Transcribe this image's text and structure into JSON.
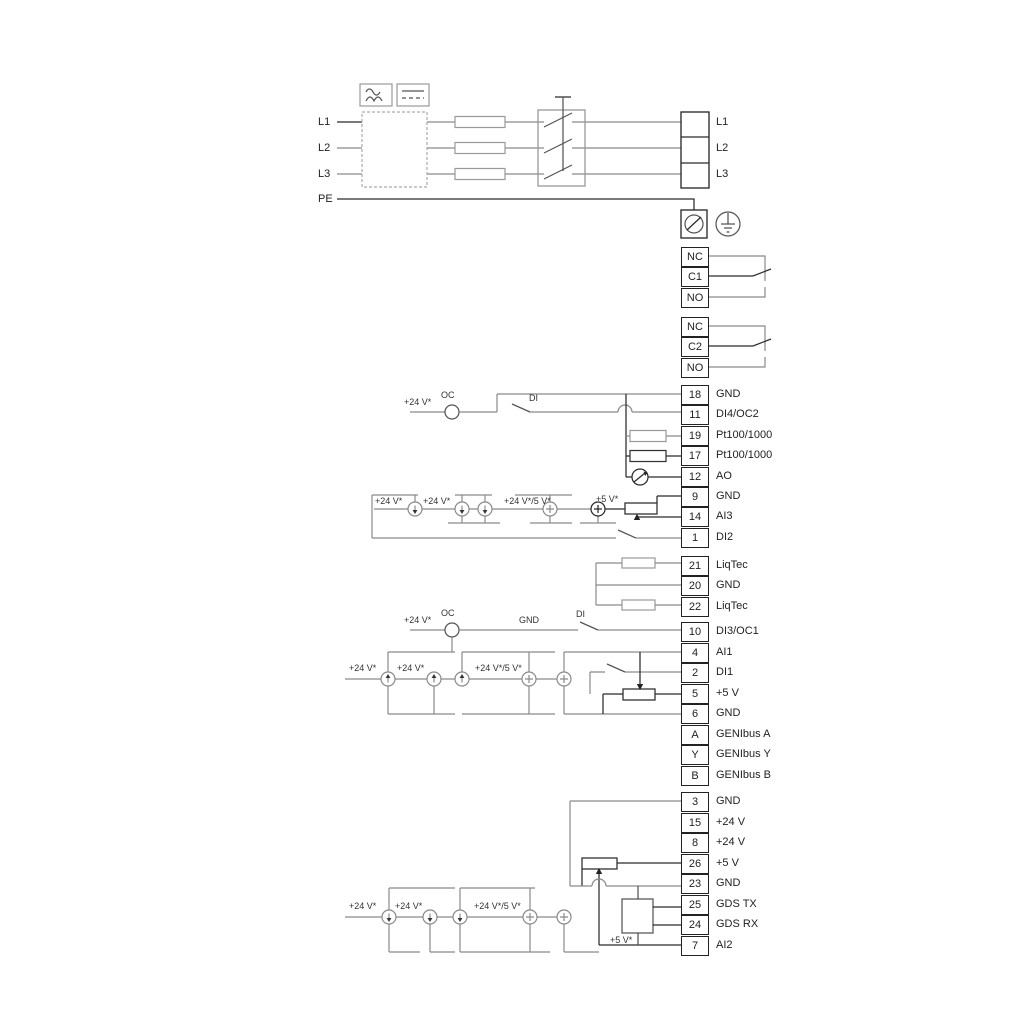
{
  "left_labels": {
    "l1": "L1",
    "l2": "L2",
    "l3": "L3",
    "pe": "PE"
  },
  "mains_out": {
    "l1": "L1",
    "l2": "L2",
    "l3": "L3"
  },
  "relays": [
    {
      "rows": [
        "NC",
        "C1",
        "NO"
      ]
    },
    {
      "rows": [
        "NC",
        "C2",
        "NO"
      ]
    }
  ],
  "stacks": {
    "io1": [
      {
        "id": "18",
        "label": "GND"
      },
      {
        "id": "11",
        "label": "DI4/OC2"
      },
      {
        "id": "19",
        "label": "Pt100/1000"
      },
      {
        "id": "17",
        "label": "Pt100/1000"
      },
      {
        "id": "12",
        "label": "AO"
      },
      {
        "id": "9",
        "label": "GND"
      },
      {
        "id": "14",
        "label": "AI3"
      },
      {
        "id": "1",
        "label": "DI2"
      }
    ],
    "liqtec": [
      {
        "id": "21",
        "label": "LiqTec"
      },
      {
        "id": "20",
        "label": "GND"
      },
      {
        "id": "22",
        "label": "LiqTec"
      }
    ],
    "io2": [
      {
        "id": "10",
        "label": "DI3/OC1"
      },
      {
        "id": "4",
        "label": "AI1"
      },
      {
        "id": "2",
        "label": "DI1"
      },
      {
        "id": "5",
        "label": "+5 V"
      },
      {
        "id": "6",
        "label": "GND"
      },
      {
        "id": "A",
        "label": "GENIbus A"
      },
      {
        "id": "Y",
        "label": "GENIbus Y"
      },
      {
        "id": "B",
        "label": "GENIbus B"
      }
    ],
    "io3": [
      {
        "id": "3",
        "label": "GND"
      },
      {
        "id": "15",
        "label": "+24 V"
      },
      {
        "id": "8",
        "label": "+24 V"
      },
      {
        "id": "26",
        "label": "+5 V"
      },
      {
        "id": "23",
        "label": "GND"
      },
      {
        "id": "25",
        "label": "GDS TX"
      },
      {
        "id": "24",
        "label": "GDS RX"
      },
      {
        "id": "7",
        "label": "AI2"
      }
    ]
  },
  "annotations": {
    "r11_v24": "+24 V*",
    "r11_oc": "OC",
    "r11_di": "DI",
    "m1_v24a": "+24 V*",
    "m1_v24b": "+24 V*",
    "m1_v245": "+24 V*/5 V*",
    "m1_v5": "+5 V*",
    "r10_v24": "+24 V*",
    "r10_oc": "OC",
    "r10_gnd": "GND",
    "r10_di": "DI",
    "m2_v24a": "+24 V*",
    "m2_v24b": "+24 V*",
    "m2_v245": "+24 V*/5 V*",
    "m3_v24a": "+24 V*",
    "m3_v24b": "+24 V*",
    "m3_v245": "+24 V*/5 V*",
    "m3_v5": "+5 V*"
  },
  "icons": {
    "ac_symbol": "ac-wave-icon",
    "dc_symbol": "dc-line-icon",
    "pe_terminal": "screw-terminal-icon",
    "earth": "earth-ground-icon"
  },
  "colors": {
    "wire_gray": "#8a8a8a",
    "wire_black": "#2b2b2b",
    "background": "#ffffff"
  }
}
